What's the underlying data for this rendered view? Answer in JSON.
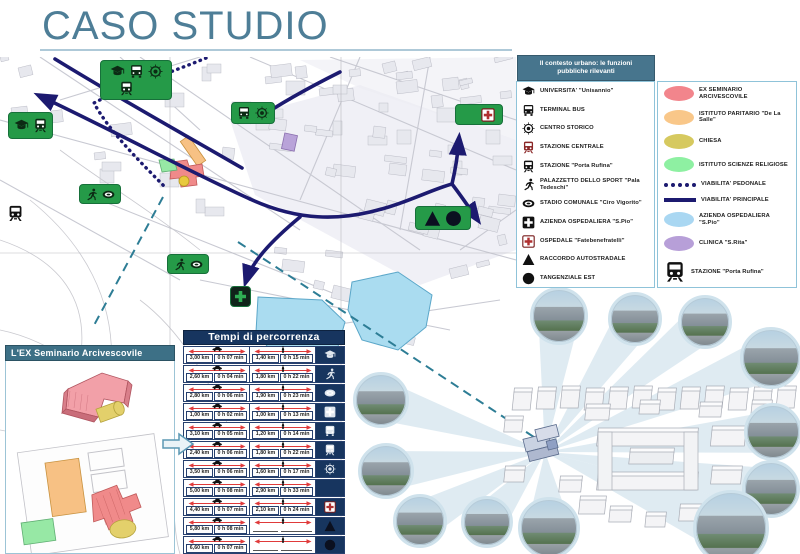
{
  "title": "CASO STUDIO",
  "legend": {
    "header": "Il contesto urbano: le funzioni pubbliche rilevanti",
    "functions": [
      {
        "icon": "grad-cap",
        "label": "UNIVERSITA' \"Unisannio\""
      },
      {
        "icon": "bus",
        "label": "TERMINAL BUS"
      },
      {
        "icon": "bullseye",
        "label": "CENTRO STORICO"
      },
      {
        "icon": "train-red",
        "label": "STAZIONE CENTRALE"
      },
      {
        "icon": "train-black",
        "label": "STAZIONE \"Porta Rufina\""
      },
      {
        "icon": "runner",
        "label": "PALAZZETTO DELLO SPORT \"Pala Tedeschi\""
      },
      {
        "icon": "stadium",
        "label": "STADIO COMUNALE \"Ciro Vigorito\""
      },
      {
        "icon": "cross-black",
        "label": "AZIENDA OSPEDALIERA \"S.Pio\""
      },
      {
        "icon": "cross-red",
        "label": "OSPEDALE \"Fatebenefratelli\""
      },
      {
        "icon": "triangle",
        "label": "RACCORDO AUTOSTRADALE"
      },
      {
        "icon": "circle",
        "label": "TANGENZIALE EST"
      }
    ],
    "areas": [
      {
        "swatch": "ellipse",
        "color": "#f2858c",
        "label": "EX SEMINARIO ARCIVESCOVILE"
      },
      {
        "swatch": "ellipse",
        "color": "#f9c789",
        "label": "ISTITUTO PARITARIO \"De La Salle\""
      },
      {
        "swatch": "ellipse",
        "color": "#d6c95f",
        "label": "CHIESA"
      },
      {
        "swatch": "ellipse",
        "color": "#8ef0a2",
        "label": "ISTITUTO SCIENZE RELIGIOSE"
      },
      {
        "swatch": "dots",
        "color": "#1c1a70",
        "label": "VIABILITA' PEDONALE"
      },
      {
        "swatch": "line",
        "color": "#1c1a70",
        "label": "VIABILITA' PRINCIPALE"
      },
      {
        "swatch": "ellipse",
        "color": "#a9d7f2",
        "label": "AZIENDA OSPEDALIERA \"S.Pio\""
      },
      {
        "swatch": "ellipse",
        "color": "#b79fd8",
        "label": "CLINICA \"S.Rita\""
      },
      {
        "swatch": "icon",
        "icon": "train-black",
        "label": "STAZIONE \"Porta Rufina\""
      }
    ]
  },
  "travel_table": {
    "title": "Tempi di percorrenza",
    "modes": [
      {
        "icon": "car-mini"
      },
      {
        "icon": "person-mini"
      }
    ],
    "rows": [
      {
        "icon": "grad-cap",
        "icon_color": "#dfe6ee",
        "car_km": "3,00 km",
        "car_time": "0 h 07 min",
        "walk_km": "1,40 km",
        "walk_time": "0 h 15 min"
      },
      {
        "icon": "runner",
        "icon_color": "#dfe6ee",
        "car_km": "2,60 km",
        "car_time": "0 h 04 min",
        "walk_km": "1,80 km",
        "walk_time": "0 h 22 min"
      },
      {
        "icon": "stadium",
        "icon_color": "#dfe6ee",
        "car_km": "2,80 km",
        "car_time": "0 h 06 min",
        "walk_km": "1,90 km",
        "walk_time": "0 h 23 min"
      },
      {
        "icon": "cross-black",
        "icon_color": "#dfe6ee",
        "car_km": "1,00 km",
        "car_time": "0 h 02 min",
        "walk_km": "1,00 km",
        "walk_time": "0 h 13 min"
      },
      {
        "icon": "bus",
        "icon_color": "#dfe6ee",
        "car_km": "3,10 km",
        "car_time": "0 h 05 min",
        "walk_km": "1,20 km",
        "walk_time": "0 h 14 min"
      },
      {
        "icon": "train-black",
        "icon_color": "#dfe6ee",
        "car_km": "2,40 km",
        "car_time": "0 h 06 min",
        "walk_km": "1,80 km",
        "walk_time": "0 h 22 min"
      },
      {
        "icon": "bullseye",
        "icon_color": "#dfe6ee",
        "car_km": "3,50 km",
        "car_time": "0 h 06 min",
        "walk_km": "1,60 km",
        "walk_time": "0 h 17 min"
      },
      {
        "icon": "train-red",
        "icon_color": "#d96b6b",
        "car_km": "5,00 km",
        "car_time": "0 h 08 min",
        "walk_km": "2,90 km",
        "walk_time": "0 h 33 min"
      },
      {
        "icon": "cross-red",
        "icon_color": "#d96b6b",
        "car_km": "4,40 km",
        "car_time": "0 h 07 min",
        "walk_km": "2,10 km",
        "walk_time": "0 h 24 min"
      },
      {
        "icon": "triangle",
        "icon_color": "#0b1020",
        "car_km": "5,80 km",
        "car_time": "0 h 08 min",
        "walk_km": "",
        "walk_time": ""
      },
      {
        "icon": "circle",
        "icon_color": "#0b1020",
        "car_km": "6,60 km",
        "car_time": "0 h 07 min",
        "walk_km": "",
        "walk_time": ""
      }
    ]
  },
  "seminario_panel": {
    "header": "L'EX Seminario Arcivescovile"
  },
  "map": {
    "badges": [
      {
        "name": "badge-cluster-centro",
        "x": 100,
        "y": 60,
        "w": 72,
        "h": 40,
        "bg": "#259a48",
        "size": 15,
        "icons": [
          {
            "n": "grad-cap",
            "c": "#0c2a14"
          },
          {
            "n": "bus",
            "c": "#0c2a14"
          },
          {
            "n": "bullseye",
            "c": "#0c2a14"
          },
          {
            "n": "train-black",
            "c": "#0c2a14"
          },
          {
            "n": "train-red",
            "c": "#8b2727"
          }
        ]
      },
      {
        "name": "badge-universita",
        "x": 8,
        "y": 112,
        "w": 45,
        "h": 27,
        "bg": "#259a48",
        "size": 15,
        "icons": [
          {
            "n": "grad-cap",
            "c": "#0c2a14"
          },
          {
            "n": "train-black",
            "c": "#0c2a14"
          }
        ]
      },
      {
        "name": "badge-terminal-centro",
        "x": 231,
        "y": 102,
        "w": 44,
        "h": 22,
        "bg": "#259a48",
        "size": 14,
        "icons": [
          {
            "n": "bus",
            "c": "#0c2a14"
          },
          {
            "n": "bullseye",
            "c": "#0c2a14"
          }
        ]
      },
      {
        "name": "badge-stazione-ospedale",
        "x": 455,
        "y": 104,
        "w": 48,
        "h": 21,
        "bg": "#259a48",
        "size": 14,
        "icons": [
          {
            "n": "train-red",
            "c": "#8b2727"
          },
          {
            "n": "cross-red",
            "c": "#8b2727"
          }
        ]
      },
      {
        "name": "badge-sport-stadio-1",
        "x": 79,
        "y": 184,
        "w": 42,
        "h": 20,
        "bg": "#259a48",
        "size": 13,
        "icons": [
          {
            "n": "runner",
            "c": "#0c2a14"
          },
          {
            "n": "stadium",
            "c": "#0c2a14"
          }
        ]
      },
      {
        "name": "badge-sport-stadio-2",
        "x": 167,
        "y": 254,
        "w": 42,
        "h": 20,
        "bg": "#259a48",
        "size": 13,
        "icons": [
          {
            "n": "runner",
            "c": "#0c2a14"
          },
          {
            "n": "stadium",
            "c": "#0c2a14"
          }
        ]
      },
      {
        "name": "badge-raccordo-tangenziale",
        "x": 415,
        "y": 206,
        "w": 56,
        "h": 24,
        "bg": "#259a48",
        "size": 17,
        "icons": [
          {
            "n": "triangle",
            "c": "#0b1020"
          },
          {
            "n": "circle",
            "c": "#0b1020"
          }
        ]
      },
      {
        "name": "badge-azienda-ospedaliera",
        "x": 230,
        "y": 286,
        "w": 21,
        "h": 21,
        "bg": "#10241a",
        "size": 15,
        "icons": [
          {
            "n": "plus",
            "c": "#2fae54"
          }
        ]
      }
    ],
    "standalone_icons": [
      {
        "name": "porta-rufina-station-icon",
        "icon": "train-black",
        "c": "#111",
        "x": 7,
        "y": 205,
        "size": 17
      }
    ],
    "photos": [
      {
        "x": 559,
        "y": 316,
        "r": 29
      },
      {
        "x": 635,
        "y": 319,
        "r": 27
      },
      {
        "x": 705,
        "y": 322,
        "r": 27
      },
      {
        "x": 771,
        "y": 358,
        "r": 31
      },
      {
        "x": 773,
        "y": 432,
        "r": 29
      },
      {
        "x": 771,
        "y": 489,
        "r": 29
      },
      {
        "x": 731,
        "y": 528,
        "r": 38
      },
      {
        "x": 549,
        "y": 528,
        "r": 31
      },
      {
        "x": 381,
        "y": 400,
        "r": 28
      },
      {
        "x": 386,
        "y": 471,
        "r": 28
      },
      {
        "x": 420,
        "y": 521,
        "r": 27
      },
      {
        "x": 487,
        "y": 522,
        "r": 26
      }
    ]
  },
  "colors": {
    "title": "#4e7e97",
    "route_principale": "#1c1a70",
    "pedonale": "#1c1a70",
    "dashed_teal": "#2d7d95",
    "hospital_area": "#aadcf0",
    "badge_green": "#259a48",
    "table_navy": "#17355f",
    "arrow_red": "#e03a3a"
  }
}
